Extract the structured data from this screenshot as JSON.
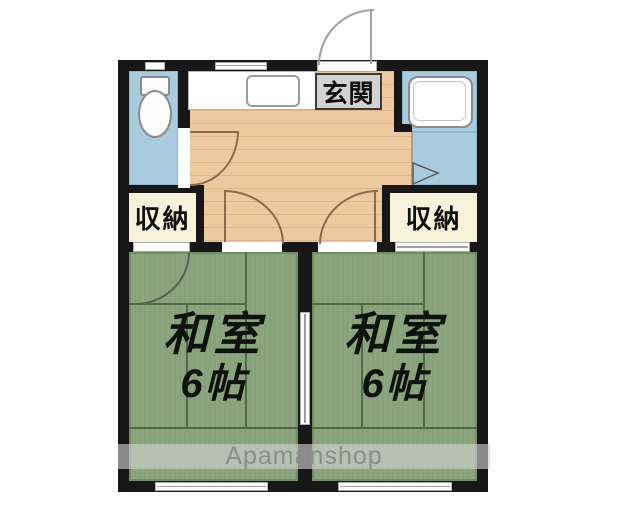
{
  "floorplan": {
    "labels": {
      "entrance": "玄関",
      "storage_left": "収納",
      "storage_right": "収納",
      "watermark": "Apamanshop"
    },
    "rooms": {
      "left": {
        "name": "和室",
        "size": "6帖"
      },
      "right": {
        "name": "和室",
        "size": "6帖"
      }
    },
    "colors": {
      "wall": "#171717",
      "tatami_green": "#8ba57d",
      "tatami_line_green": "#4e6a47",
      "wood_floor": "#ecc99e",
      "water_blue": "#a9cbde",
      "closet_cream": "#f7f3da",
      "entrance_label_bg": "#d2d2d2",
      "watermark_gray": "#8d8d8d"
    },
    "icons": [
      "toilet-icon",
      "bathtub-icon",
      "kitchen-sink-icon",
      "kitchen-counter-icon",
      "hinged-door-icon",
      "sliding-door-icon",
      "folding-door-icon",
      "window-icon"
    ]
  }
}
